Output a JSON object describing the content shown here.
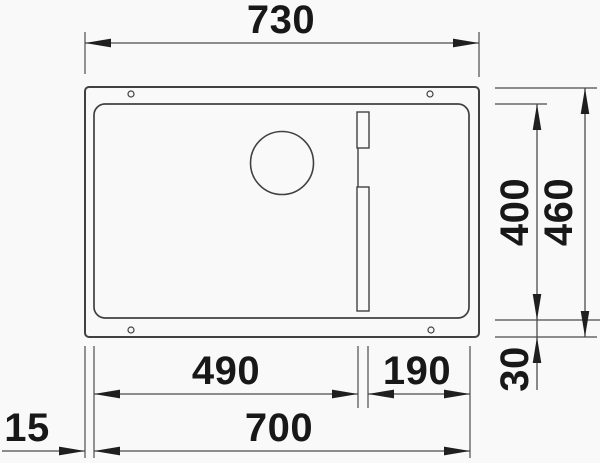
{
  "figure": {
    "type": "sink-technical-drawing",
    "background_color": "#f9f9f9",
    "line_color": "#414141",
    "dimension_line_color": "#4c4c4c",
    "text_color": "#181818"
  },
  "dimensions": {
    "overall_width": "730",
    "bowl_width_left": "490",
    "bowl_width_right": "190",
    "cutout_width": "700",
    "edge_offset_left": "15",
    "bowl_depth": "400",
    "overall_depth": "460",
    "edge_offset_bottom": "30"
  }
}
